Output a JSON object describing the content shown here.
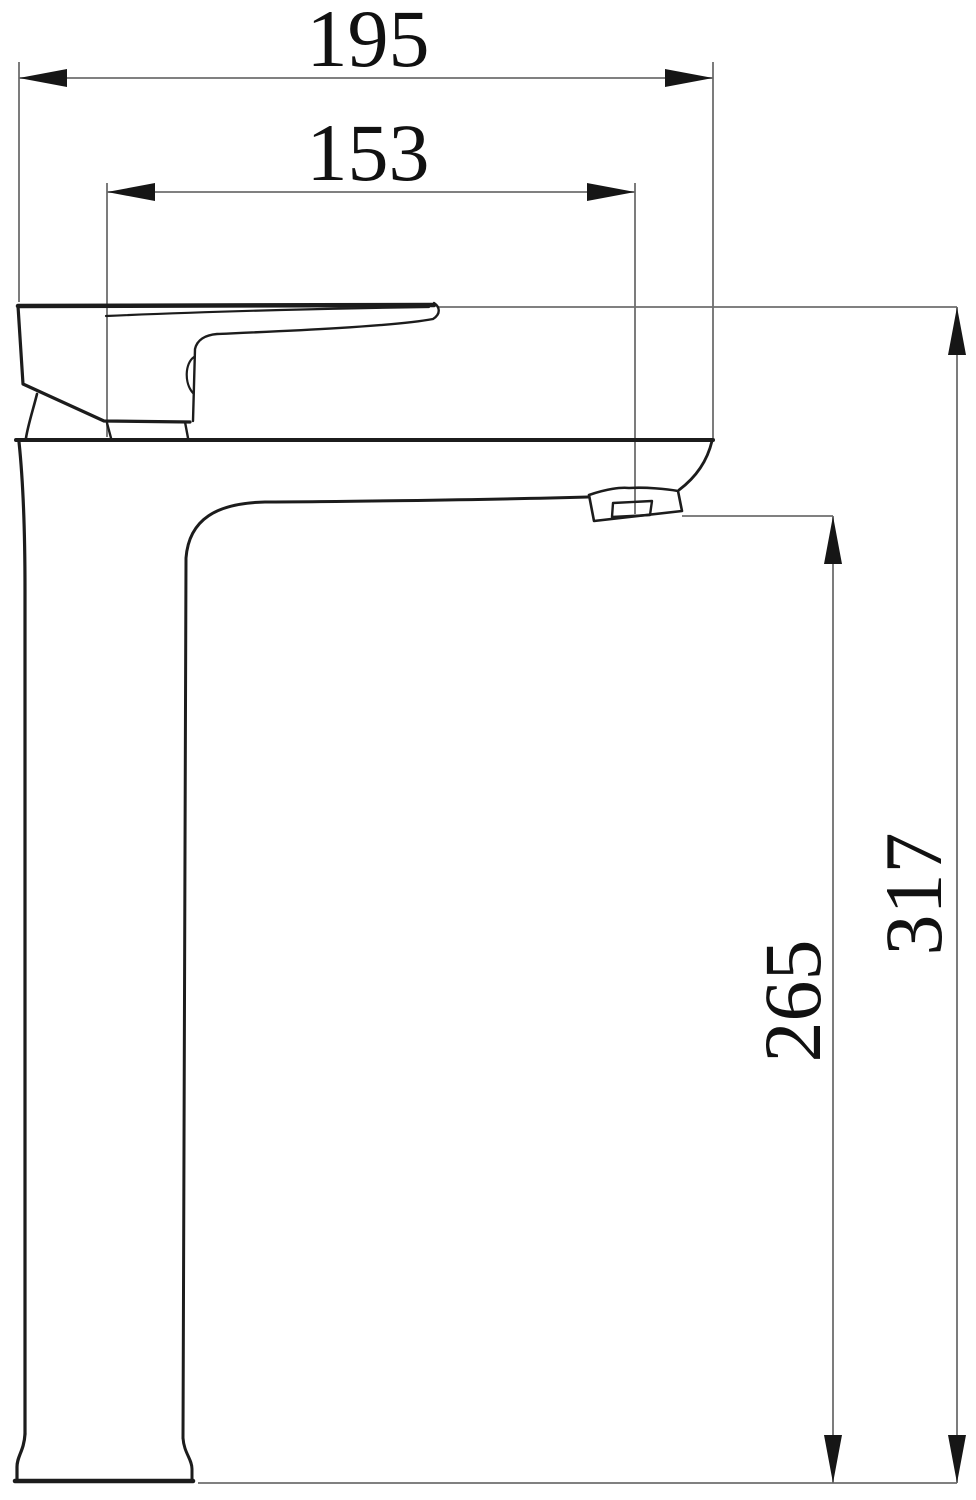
{
  "dimensions": {
    "total_width": {
      "label": "195",
      "orientation": "horizontal"
    },
    "spout_reach": {
      "label": "153",
      "orientation": "horizontal"
    },
    "total_height": {
      "label": "317",
      "orientation": "vertical"
    },
    "spout_height": {
      "label": "265",
      "orientation": "vertical"
    }
  },
  "colors": {
    "outline": "#1c1c1c",
    "dimension_line": "#6e6e6e",
    "arrow": "#161616",
    "label_text": "#111111",
    "background": "#ffffff"
  }
}
